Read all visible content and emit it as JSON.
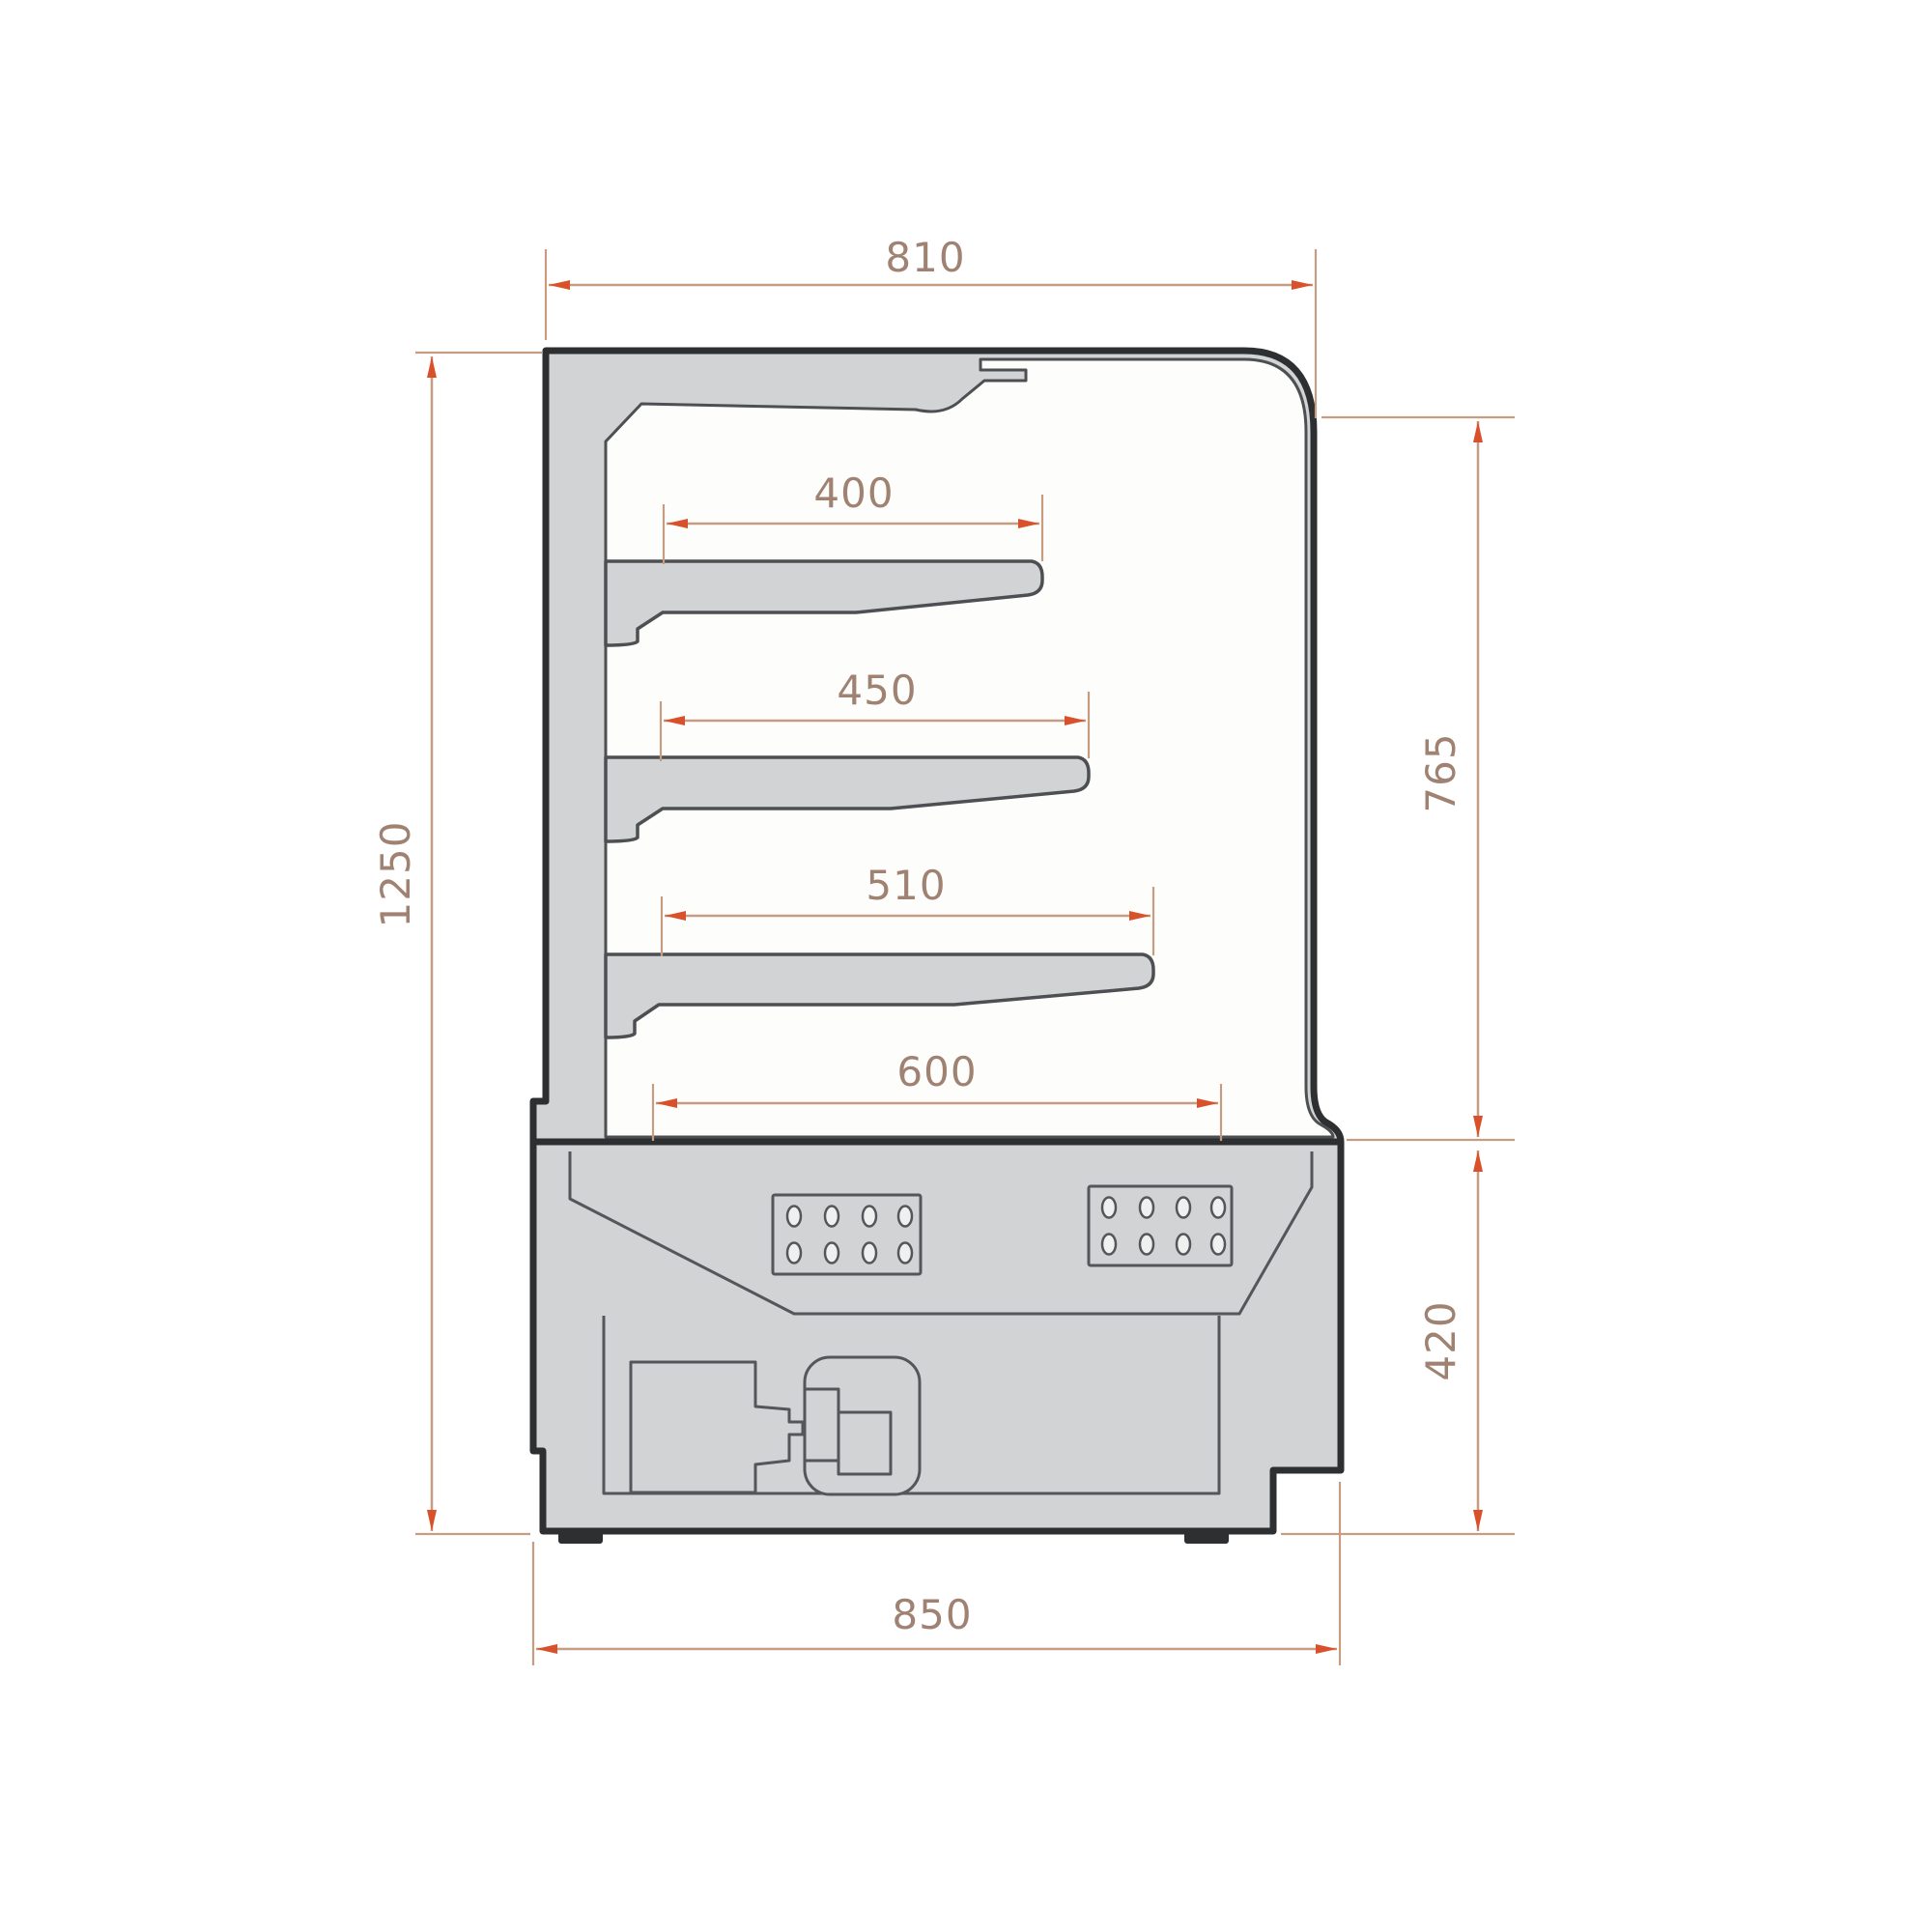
{
  "meta": {
    "type": "technical-dimension-drawing",
    "subject": "refrigerated open display cabinet, side cross-section",
    "units": "mm"
  },
  "colors": {
    "outline": "#2e2f31",
    "line": "#55565a",
    "line_strong": "#4e4f52",
    "fill": "#d2d3d5",
    "paper": "#fdfdfc",
    "hole": "#eff1f1",
    "dim_line": "#c69c82",
    "dim_arrow": "#d8512a",
    "dim_text": "#a08272",
    "background": "#ffffff"
  },
  "dimensions": {
    "top_width": {
      "label": "810",
      "meaning": "overall top depth"
    },
    "overall_height": {
      "label": "1250",
      "meaning": "overall height"
    },
    "shelf_1_depth": {
      "label": "400",
      "meaning": "upper shelf depth"
    },
    "shelf_2_depth": {
      "label": "450",
      "meaning": "middle shelf depth"
    },
    "shelf_3_depth": {
      "label": "510",
      "meaning": "lower shelf depth"
    },
    "upper_height": {
      "label": "765",
      "meaning": "display section height"
    },
    "deck_depth": {
      "label": "600",
      "meaning": "base deck depth"
    },
    "base_height": {
      "label": "420",
      "meaning": "base section height"
    },
    "base_width": {
      "label": "850",
      "meaning": "overall base depth"
    }
  }
}
